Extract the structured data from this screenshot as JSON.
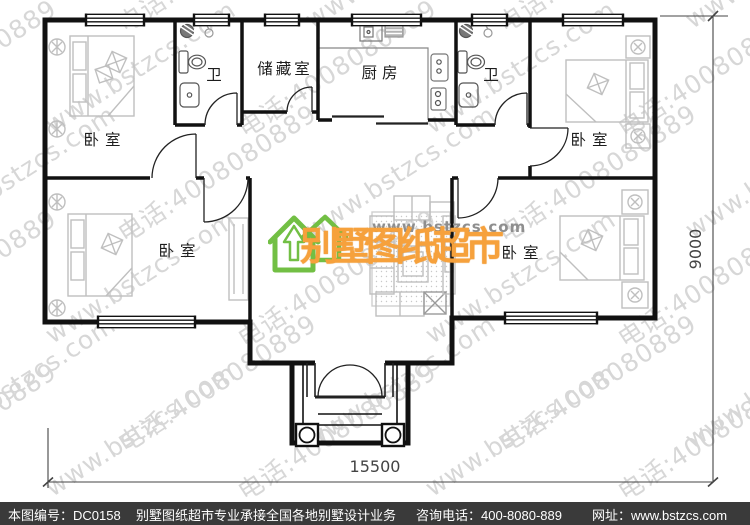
{
  "floor_plan": {
    "labels": {
      "bedroom": "卧室",
      "bathroom": "卫",
      "storage": "储藏室",
      "kitchen": "厨房"
    },
    "dimensions": {
      "width": "15500",
      "height": "9000"
    }
  },
  "logo": {
    "url": "www.bstzcs.com",
    "brand": "别墅图纸超市"
  },
  "watermark": {
    "line1": "www.bstzcs.com",
    "line2": "电话:4008080889"
  },
  "footer": {
    "plan_no": "本图编号：DC0158",
    "service": "别墅图纸超市专业承接全国各地别墅设计业务",
    "hotline": "咨询电话：400-8080-889",
    "website": "网址：www.bstzcs.com"
  },
  "colors": {
    "brand_orange": "#f6a13c",
    "brand_green": "#72bf44",
    "wall": "#111111",
    "furniture": "#bfbfbf",
    "footer_bg": "#3a3a3a",
    "watermark": "#d7d7d7"
  }
}
